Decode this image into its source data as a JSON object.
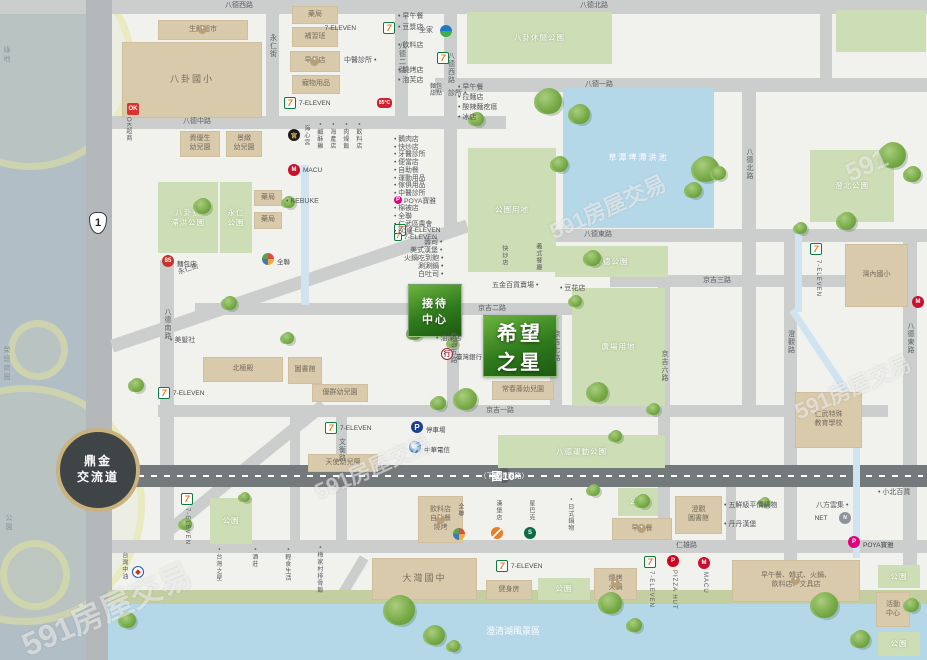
{
  "meta": {
    "watermark": "591房屋交易",
    "region": "仁武 八卦寮生活圈"
  },
  "hero": {
    "project": {
      "t": "希望|之星",
      "x": 483,
      "y": 315,
      "w": 74,
      "h": 62
    },
    "reception": {
      "t": "接待|中心",
      "x": 408,
      "y": 284,
      "w": 54,
      "h": 53
    }
  },
  "interchange": {
    "t": "鼎金|交流道",
    "x": 56,
    "y": 428,
    "d": 84
  },
  "shield": {
    "t": "1",
    "x": 89,
    "y": 212
  },
  "hwy10": {
    "x": 108,
    "y": 465,
    "w": 819,
    "h": 22,
    "t1": "國10",
    "t2": "（下方澄觀路）",
    "px": 498,
    "py": 468
  },
  "roads_h": [
    {
      "x": 0,
      "y": 0,
      "w": 927,
      "h": 14
    },
    {
      "x": 435,
      "y": 78,
      "w": 492,
      "h": 14,
      "t": "八德一路",
      "lx": 585,
      "ly": 81
    },
    {
      "x": 88,
      "y": 116,
      "w": 418,
      "h": 13,
      "t": "八德中路",
      "lx": 183,
      "ly": 118
    },
    {
      "x": 555,
      "y": 229,
      "w": 372,
      "h": 13,
      "t": "八德東路",
      "lx": 584,
      "ly": 231
    },
    {
      "x": 610,
      "y": 275,
      "w": 280,
      "h": 12,
      "t": "京吉三路",
      "lx": 703,
      "ly": 277
    },
    {
      "x": 195,
      "y": 303,
      "w": 415,
      "h": 12,
      "t": "京吉二路",
      "lx": 478,
      "ly": 305
    },
    {
      "x": 158,
      "y": 405,
      "w": 730,
      "h": 12,
      "t": "京吉一路",
      "lx": 486,
      "ly": 407
    },
    {
      "x": 108,
      "y": 540,
      "w": 819,
      "h": 13,
      "t": "仁雄路",
      "lx": 676,
      "ly": 542
    }
  ],
  "roads_v": [
    {
      "x": 86,
      "y": 0,
      "w": 26,
      "h": 660,
      "dark": true
    },
    {
      "x": 266,
      "y": 14,
      "w": 13,
      "h": 104,
      "t": "永仁街",
      "ly": 34
    },
    {
      "x": 395,
      "y": 14,
      "w": 13,
      "h": 104,
      "t": "八德二路",
      "ly": 42
    },
    {
      "x": 444,
      "y": 14,
      "w": 13,
      "h": 218,
      "t": "八德西路",
      "ly": 52
    },
    {
      "x": 160,
      "y": 260,
      "w": 14,
      "h": 280,
      "t": "八德南路",
      "ly": 308
    },
    {
      "x": 447,
      "y": 315,
      "w": 12,
      "h": 91,
      "t": "京吉五路",
      "ly": 332
    },
    {
      "x": 550,
      "y": 315,
      "w": 12,
      "h": 91,
      "t": "京吉七路",
      "ly": 330
    },
    {
      "x": 658,
      "y": 287,
      "w": 12,
      "h": 253,
      "t": "京吉六路",
      "ly": 350
    },
    {
      "x": 742,
      "y": 92,
      "w": 14,
      "h": 315,
      "t": "八德北路",
      "ly": 148
    },
    {
      "x": 784,
      "y": 229,
      "w": 13,
      "h": 356,
      "t": "澄觀路",
      "ly": 330
    },
    {
      "x": 903,
      "y": 229,
      "w": 14,
      "h": 340,
      "t": "八德東路",
      "ly": 322
    },
    {
      "x": 336,
      "y": 405,
      "w": 11,
      "h": 136,
      "t": "文衡路",
      "ly": 438
    },
    {
      "x": 290,
      "y": 405,
      "w": 10,
      "h": 136
    },
    {
      "x": 726,
      "y": 479,
      "w": 10,
      "h": 62
    },
    {
      "x": 820,
      "y": 0,
      "w": 12,
      "h": 78
    }
  ],
  "roads_d": [
    {
      "x": 110,
      "y": 340,
      "w": 375,
      "h": 13,
      "r": -18.7,
      "t": "永仁街",
      "tx": 178,
      "ty": 266,
      "tr": -19
    },
    {
      "x": 160,
      "y": 530,
      "w": 206,
      "h": 12,
      "r": -39.1
    },
    {
      "x": 330,
      "y": 605,
      "w": 58,
      "h": 10,
      "r": -59
    }
  ],
  "streams": [
    {
      "x": 301,
      "y": 165,
      "w": 8,
      "h": 140
    },
    {
      "x": 795,
      "y": 230,
      "w": 7,
      "h": 82
    },
    {
      "x": 795,
      "y": 308,
      "w": 110,
      "h": 7,
      "r": 56.4
    },
    {
      "x": 853,
      "y": 398,
      "w": 7,
      "h": 160
    }
  ],
  "waters": [
    {
      "t": "草潭埤滯洪池",
      "x": 563,
      "y": 88,
      "w": 151,
      "h": 140
    },
    {
      "t": "",
      "x": 108,
      "y": 604,
      "w": 819,
      "h": 56
    }
  ],
  "shore": {
    "x": 108,
    "y": 590,
    "w": 819,
    "h": 16
  },
  "parks": [
    {
      "t": "八卦休閒公園",
      "x": 467,
      "y": 12,
      "w": 145,
      "h": 52
    },
    {
      "t": "",
      "x": 836,
      "y": 10,
      "w": 90,
      "h": 42
    },
    {
      "t": "八卦寮|滯洪公園",
      "x": 158,
      "y": 182,
      "w": 60,
      "h": 71
    },
    {
      "t": "永仁|公園",
      "x": 220,
      "y": 182,
      "w": 32,
      "h": 71
    },
    {
      "t": "澄北公園",
      "x": 810,
      "y": 150,
      "w": 84,
      "h": 72
    },
    {
      "t": "公園用地",
      "x": 468,
      "y": 148,
      "w": 88,
      "h": 124
    },
    {
      "t": "承德公園",
      "x": 555,
      "y": 246,
      "w": 113,
      "h": 31
    },
    {
      "t": "廣場用地",
      "x": 572,
      "y": 288,
      "w": 93,
      "h": 118
    },
    {
      "t": "八德運動公園",
      "x": 498,
      "y": 435,
      "w": 167,
      "h": 33
    },
    {
      "t": "公園",
      "x": 210,
      "y": 498,
      "w": 42,
      "h": 46
    },
    {
      "t": "公園",
      "x": 618,
      "y": 488,
      "w": 40,
      "h": 28
    },
    {
      "t": "公園",
      "x": 538,
      "y": 578,
      "w": 52,
      "h": 22
    },
    {
      "t": "公園",
      "x": 878,
      "y": 565,
      "w": 42,
      "h": 23
    },
    {
      "t": "公園",
      "x": 878,
      "y": 632,
      "w": 42,
      "h": 24
    }
  ],
  "buildings": [
    {
      "t": "八卦國小",
      "x": 122,
      "y": 42,
      "w": 140,
      "h": 76,
      "big": true
    },
    {
      "t": "生鮮超市",
      "x": 158,
      "y": 20,
      "w": 90,
      "h": 20,
      "icon": "shop"
    },
    {
      "t": "藥局",
      "x": 292,
      "y": 6,
      "w": 46,
      "h": 18
    },
    {
      "t": "補習班",
      "x": 292,
      "y": 27,
      "w": 46,
      "h": 20
    },
    {
      "t": "早餐店",
      "x": 290,
      "y": 51,
      "w": 50,
      "h": 21,
      "icon": "shop"
    },
    {
      "t": "寵物用品",
      "x": 292,
      "y": 75,
      "w": 48,
      "h": 19
    },
    {
      "t": "資優生|幼兒園",
      "x": 180,
      "y": 131,
      "w": 40,
      "h": 26
    },
    {
      "t": "景緻|幼兒園",
      "x": 226,
      "y": 131,
      "w": 36,
      "h": 26
    },
    {
      "t": "藥局",
      "x": 254,
      "y": 190,
      "w": 28,
      "h": 16
    },
    {
      "t": "藥局",
      "x": 254,
      "y": 212,
      "w": 28,
      "h": 17
    },
    {
      "t": "北極殿",
      "x": 203,
      "y": 357,
      "w": 80,
      "h": 25
    },
    {
      "t": "圖書館",
      "x": 288,
      "y": 357,
      "w": 34,
      "h": 27
    },
    {
      "t": "優群幼兒園",
      "x": 312,
      "y": 384,
      "w": 56,
      "h": 18
    },
    {
      "t": "天使幼兒園",
      "x": 308,
      "y": 454,
      "w": 70,
      "h": 18
    },
    {
      "t": "常春藤幼兒園",
      "x": 492,
      "y": 381,
      "w": 62,
      "h": 19
    },
    {
      "t": "大灣國中",
      "x": 372,
      "y": 558,
      "w": 105,
      "h": 42,
      "big": true
    },
    {
      "t": "健身房",
      "x": 486,
      "y": 580,
      "w": 46,
      "h": 20
    },
    {
      "t": "燒烤|火鍋",
      "x": 594,
      "y": 568,
      "w": 43,
      "h": 32,
      "icon": "shop"
    },
    {
      "t": "早午餐",
      "x": 612,
      "y": 518,
      "w": 60,
      "h": 22,
      "icon": "shop"
    },
    {
      "t": "飲料店|自助餐|燒烤",
      "x": 418,
      "y": 496,
      "w": 45,
      "h": 47,
      "icon": "shop"
    },
    {
      "t": "澄觀|圖書館",
      "x": 675,
      "y": 496,
      "w": 47,
      "h": 38
    },
    {
      "t": "仁武特殊|教育學校",
      "x": 795,
      "y": 392,
      "w": 67,
      "h": 56
    },
    {
      "t": "灣內國小",
      "x": 845,
      "y": 244,
      "w": 63,
      "h": 63
    },
    {
      "t": "早午餐、韓式、火鍋、|飲料店、文具店",
      "x": 732,
      "y": 560,
      "w": 128,
      "h": 42,
      "icon": "shop"
    },
    {
      "t": "活動|中心",
      "x": 876,
      "y": 592,
      "w": 34,
      "h": 35
    }
  ],
  "icon_glyphs": {
    "seven": "7",
    "fami": "",
    "macu": "M",
    "pizza": "P",
    "poya": "P",
    "ok": "OK",
    "px": "",
    "pxball": "",
    "bank": "行",
    "cht": "",
    "cpc": "◆",
    "sbux": "S",
    "burger": "",
    "e85": "85°C",
    "temple": "宮",
    "net": "N",
    "bakery": "85",
    "parking": "P",
    "shop": "•"
  },
  "pois": [
    {
      "i": "seven",
      "x": 383,
      "y": 22,
      "l": "7-ELEVEN",
      "lp": "l"
    },
    {
      "i": "fami",
      "x": 440,
      "y": 25
    },
    {
      "i": "seven",
      "x": 437,
      "y": 52
    },
    {
      "i": "seven",
      "x": 284,
      "y": 97,
      "l": "7-ELEVEN",
      "lp": "r"
    },
    {
      "i": "e85",
      "x": 377,
      "y": 98
    },
    {
      "i": "ok",
      "x": 127,
      "y": 103
    },
    {
      "i": "temple",
      "x": 288,
      "y": 129
    },
    {
      "i": "macu",
      "x": 288,
      "y": 164,
      "l": "MACU",
      "lp": "r"
    },
    {
      "i": "bakery",
      "x": 162,
      "y": 255,
      "l": "麵包店",
      "lp": "r"
    },
    {
      "i": "px",
      "x": 262,
      "y": 253,
      "l": "全聯",
      "lp": "r"
    },
    {
      "i": "seven",
      "x": 158,
      "y": 387,
      "l": "7-ELEVEN",
      "lp": "r"
    },
    {
      "i": "bank",
      "x": 441,
      "y": 348,
      "l": "臺灣銀行",
      "lp": "r"
    },
    {
      "i": "seven",
      "x": 394,
      "y": 224,
      "l": "7-ELEVEN",
      "lp": "r"
    },
    {
      "i": "parking",
      "x": 411,
      "y": 421,
      "l": "停車場",
      "lp": "r"
    },
    {
      "i": "cht",
      "x": 409,
      "y": 441,
      "l": "中華電信",
      "lp": "r"
    },
    {
      "i": "seven",
      "x": 325,
      "y": 422,
      "l": "7-ELEVEN",
      "lp": "r"
    },
    {
      "i": "cpc",
      "x": 132,
      "y": 566
    },
    {
      "i": "seven",
      "x": 181,
      "y": 493
    },
    {
      "i": "pxball",
      "x": 453,
      "y": 528
    },
    {
      "i": "burger",
      "x": 491,
      "y": 527
    },
    {
      "i": "sbux",
      "x": 524,
      "y": 527
    },
    {
      "i": "seven",
      "x": 496,
      "y": 560,
      "l": "7-ELEVEN",
      "lp": "r"
    },
    {
      "i": "seven",
      "x": 644,
      "y": 556
    },
    {
      "i": "pizza",
      "x": 667,
      "y": 555
    },
    {
      "i": "macu",
      "x": 698,
      "y": 557
    },
    {
      "i": "seven",
      "x": 810,
      "y": 243
    },
    {
      "i": "macu",
      "x": 912,
      "y": 296
    },
    {
      "i": "poya",
      "x": 848,
      "y": 536,
      "l": "POYA寶雅",
      "lp": "r"
    },
    {
      "i": "net",
      "x": 839,
      "y": 512,
      "l": "NET",
      "lp": "l"
    }
  ],
  "shoplist": {
    "x": 394,
    "y": 133,
    "lh": 7.7,
    "items": [
      "• 鵝肉店",
      "• 快炒店",
      "• 牙醫診所",
      "• 便當店",
      "• 自助餐",
      "• 運動用品",
      "• 傢俱用品",
      "• 中醫診所",
      "POYA寶雅",
      "• 棉被店",
      "• 全聯",
      "• 仁武區農會",
      "• 50嵐",
      "7-ELEVEN"
    ],
    "icons": {
      "8": "poya",
      "13": "seven"
    }
  },
  "labels": [
    {
      "t": "八德西路",
      "x": 225,
      "y": 2,
      "c": "rd"
    },
    {
      "t": "八德北路",
      "x": 580,
      "y": 2,
      "c": "rd"
    },
    {
      "t": "中醫診所 •",
      "x": 344,
      "y": 57
    },
    {
      "t": "• 早午餐",
      "x": 398,
      "y": 13
    },
    {
      "t": "• 豆漿店",
      "x": 398,
      "y": 24
    },
    {
      "t": "全家",
      "x": 419,
      "y": 27
    },
    {
      "t": "• 飲料店",
      "x": 398,
      "y": 42
    },
    {
      "t": "• 燒烤店",
      "x": 398,
      "y": 67
    },
    {
      "t": "• 泡芙店",
      "x": 398,
      "y": 77
    },
    {
      "t": "麵包|甜點",
      "x": 430,
      "y": 84,
      "s": 6
    },
    {
      "t": "診所 •",
      "x": 448,
      "y": 90
    },
    {
      "t": "• 早午餐",
      "x": 458,
      "y": 84
    },
    {
      "t": "• 拉麵店",
      "x": 458,
      "y": 94
    },
    {
      "t": "• 酸辣麵疙瘩",
      "x": 458,
      "y": 104
    },
    {
      "t": "• 冰店",
      "x": 458,
      "y": 114
    },
    {
      "t": "• KEBUKE",
      "x": 286,
      "y": 198,
      "s": 7
    },
    {
      "t": "• 美髮社",
      "x": 170,
      "y": 337
    },
    {
      "t": "• 油漆店",
      "x": 436,
      "y": 335
    },
    {
      "t": "五金百貨賣場 •",
      "x": 492,
      "y": 282
    },
    {
      "t": "• 豆花店",
      "x": 560,
      "y": 285
    },
    {
      "t": "• 五鮮級平價鍋物",
      "x": 724,
      "y": 502
    },
    {
      "t": "• 丹丹漢堡",
      "x": 724,
      "y": 521
    },
    {
      "t": "八方雲集 •",
      "x": 816,
      "y": 502
    },
    {
      "t": "• 小北百貨",
      "x": 878,
      "y": 489
    },
    {
      "t": "澄清湖風景區",
      "x": 486,
      "y": 626,
      "c": "wt",
      "s": 9
    },
    {
      "t": "綠地",
      "x": 2,
      "y": 46,
      "v": 1,
      "c": "lt"
    },
    {
      "t": "榮總商圈",
      "x": 2,
      "y": 346,
      "v": 1,
      "c": "lt"
    },
    {
      "t": "公園",
      "x": 4,
      "y": 514,
      "v": 1,
      "c": "lt"
    },
    {
      "t": "• 台灣之星",
      "x": 214,
      "y": 548,
      "v": 1,
      "s": 6
    },
    {
      "t": "• 酒莊",
      "x": 250,
      "y": 548,
      "v": 1,
      "s": 6
    },
    {
      "t": "• 輕食生活",
      "x": 283,
      "y": 548,
      "v": 1,
      "s": 6
    },
    {
      "t": "• 梅家村排骨飯",
      "x": 315,
      "y": 546,
      "v": 1,
      "s": 6
    },
    {
      "t": "海心宮",
      "x": 302,
      "y": 125,
      "v": 1,
      "s": 6
    },
    {
      "t": "• 鹹酥雞",
      "x": 315,
      "y": 123,
      "v": 1,
      "s": 6
    },
    {
      "t": "• 海產店",
      "x": 328,
      "y": 123,
      "v": 1,
      "s": 6
    },
    {
      "t": "• 肉燥飯",
      "x": 341,
      "y": 123,
      "v": 1,
      "s": 6
    },
    {
      "t": "• 飲料店",
      "x": 354,
      "y": 123,
      "v": 1,
      "s": 6
    },
    {
      "t": "快炒店",
      "x": 500,
      "y": 245,
      "v": 1,
      "s": 6
    },
    {
      "t": "義式餐廳",
      "x": 534,
      "y": 243,
      "v": 1,
      "s": 6
    },
    {
      "t": "壽司 •",
      "x": 424,
      "y": 239
    },
    {
      "t": "美式漢堡 •",
      "x": 410,
      "y": 247
    },
    {
      "t": "火鍋吃到飽 •",
      "x": 404,
      "y": 255
    },
    {
      "t": "涮涮鍋 •",
      "x": 418,
      "y": 263
    },
    {
      "t": "白吐司 •",
      "x": 418,
      "y": 271
    },
    {
      "t": "OK超商",
      "x": 124,
      "y": 117,
      "v": 1,
      "s": 6
    },
    {
      "t": "台灣中油",
      "x": 120,
      "y": 552,
      "v": 1,
      "s": 6
    },
    {
      "t": "7-ELEVEN",
      "x": 183,
      "y": 508,
      "v": 1,
      "s": 6
    },
    {
      "t": "全聯",
      "x": 456,
      "y": 503,
      "v": 1,
      "s": 6
    },
    {
      "t": "漢堡店",
      "x": 494,
      "y": 500,
      "v": 1,
      "s": 6
    },
    {
      "t": "星巴克",
      "x": 527,
      "y": 500,
      "v": 1,
      "s": 6
    },
    {
      "t": "• 日式鍋物",
      "x": 566,
      "y": 498,
      "v": 1,
      "s": 6
    },
    {
      "t": "7-ELEVEN",
      "x": 647,
      "y": 571,
      "v": 1,
      "s": 6
    },
    {
      "t": "PIZZA HUT",
      "x": 670,
      "y": 570,
      "v": 1,
      "s": 6
    },
    {
      "t": "MACU",
      "x": 701,
      "y": 572,
      "v": 1,
      "s": 6
    },
    {
      "t": "7-ELEVEN",
      "x": 814,
      "y": 260,
      "v": 1,
      "s": 6
    }
  ],
  "trees": [
    [
      195,
      198,
      16
    ],
    [
      283,
      196,
      12
    ],
    [
      130,
      378,
      14
    ],
    [
      223,
      296,
      14
    ],
    [
      282,
      332,
      12
    ],
    [
      536,
      88,
      26
    ],
    [
      570,
      104,
      20
    ],
    [
      552,
      156,
      16
    ],
    [
      470,
      112,
      14
    ],
    [
      693,
      156,
      26
    ],
    [
      686,
      182,
      16
    ],
    [
      712,
      166,
      14
    ],
    [
      880,
      142,
      26
    ],
    [
      905,
      166,
      16
    ],
    [
      838,
      212,
      18
    ],
    [
      795,
      222,
      12
    ],
    [
      408,
      326,
      14
    ],
    [
      448,
      338,
      10
    ],
    [
      455,
      388,
      22
    ],
    [
      432,
      396,
      14
    ],
    [
      585,
      250,
      16
    ],
    [
      570,
      295,
      12
    ],
    [
      588,
      382,
      20
    ],
    [
      648,
      403,
      12
    ],
    [
      610,
      430,
      12
    ],
    [
      588,
      484,
      12
    ],
    [
      636,
      494,
      14
    ],
    [
      760,
      497,
      10
    ],
    [
      180,
      518,
      12
    ],
    [
      240,
      492,
      10
    ],
    [
      385,
      595,
      30
    ],
    [
      425,
      625,
      20
    ],
    [
      448,
      640,
      12
    ],
    [
      600,
      592,
      22
    ],
    [
      628,
      618,
      14
    ],
    [
      812,
      592,
      26
    ],
    [
      852,
      630,
      18
    ],
    [
      120,
      612,
      16
    ],
    [
      905,
      598,
      14
    ]
  ],
  "bubbles": [
    [
      -75,
      -40,
      210
    ],
    [
      8,
      320,
      60
    ],
    [
      -95,
      385,
      240
    ],
    [
      0,
      540,
      70
    ]
  ],
  "watermarks": [
    {
      "t": "591房屋交易",
      "x": 15,
      "y": 585,
      "s": 32
    },
    {
      "t": "591房屋交易",
      "x": 310,
      "y": 450,
      "s": 22
    },
    {
      "t": "591房屋交易",
      "x": 545,
      "y": 190,
      "s": 22
    },
    {
      "t": "591房屋交易",
      "x": 790,
      "y": 370,
      "s": 22
    },
    {
      "t": "591",
      "x": 845,
      "y": 150,
      "s": 26
    }
  ]
}
